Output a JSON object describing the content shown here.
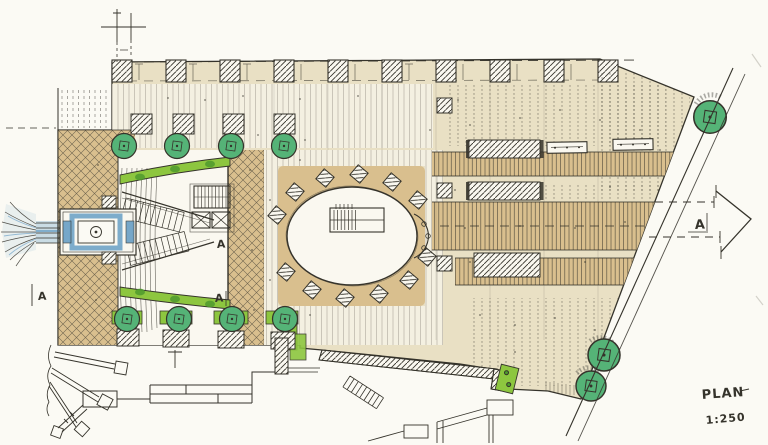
{
  "labels": {
    "plan": "PLAN",
    "scale": "1:250",
    "section": "A"
  },
  "colors": {
    "paper": "#fbfaf4",
    "ink": "#35332b",
    "beige": "#e9e0c4",
    "beige_light": "#f4f0e1",
    "tan": "#d9bf8e",
    "green_tree": "#55b377",
    "green_planter": "#8dc63f",
    "green_dark": "#4f9a2e",
    "water_blue": "#6fa3c7",
    "pencil_gray": "#b9b7ae",
    "white_zone": "#faf8f0"
  }
}
